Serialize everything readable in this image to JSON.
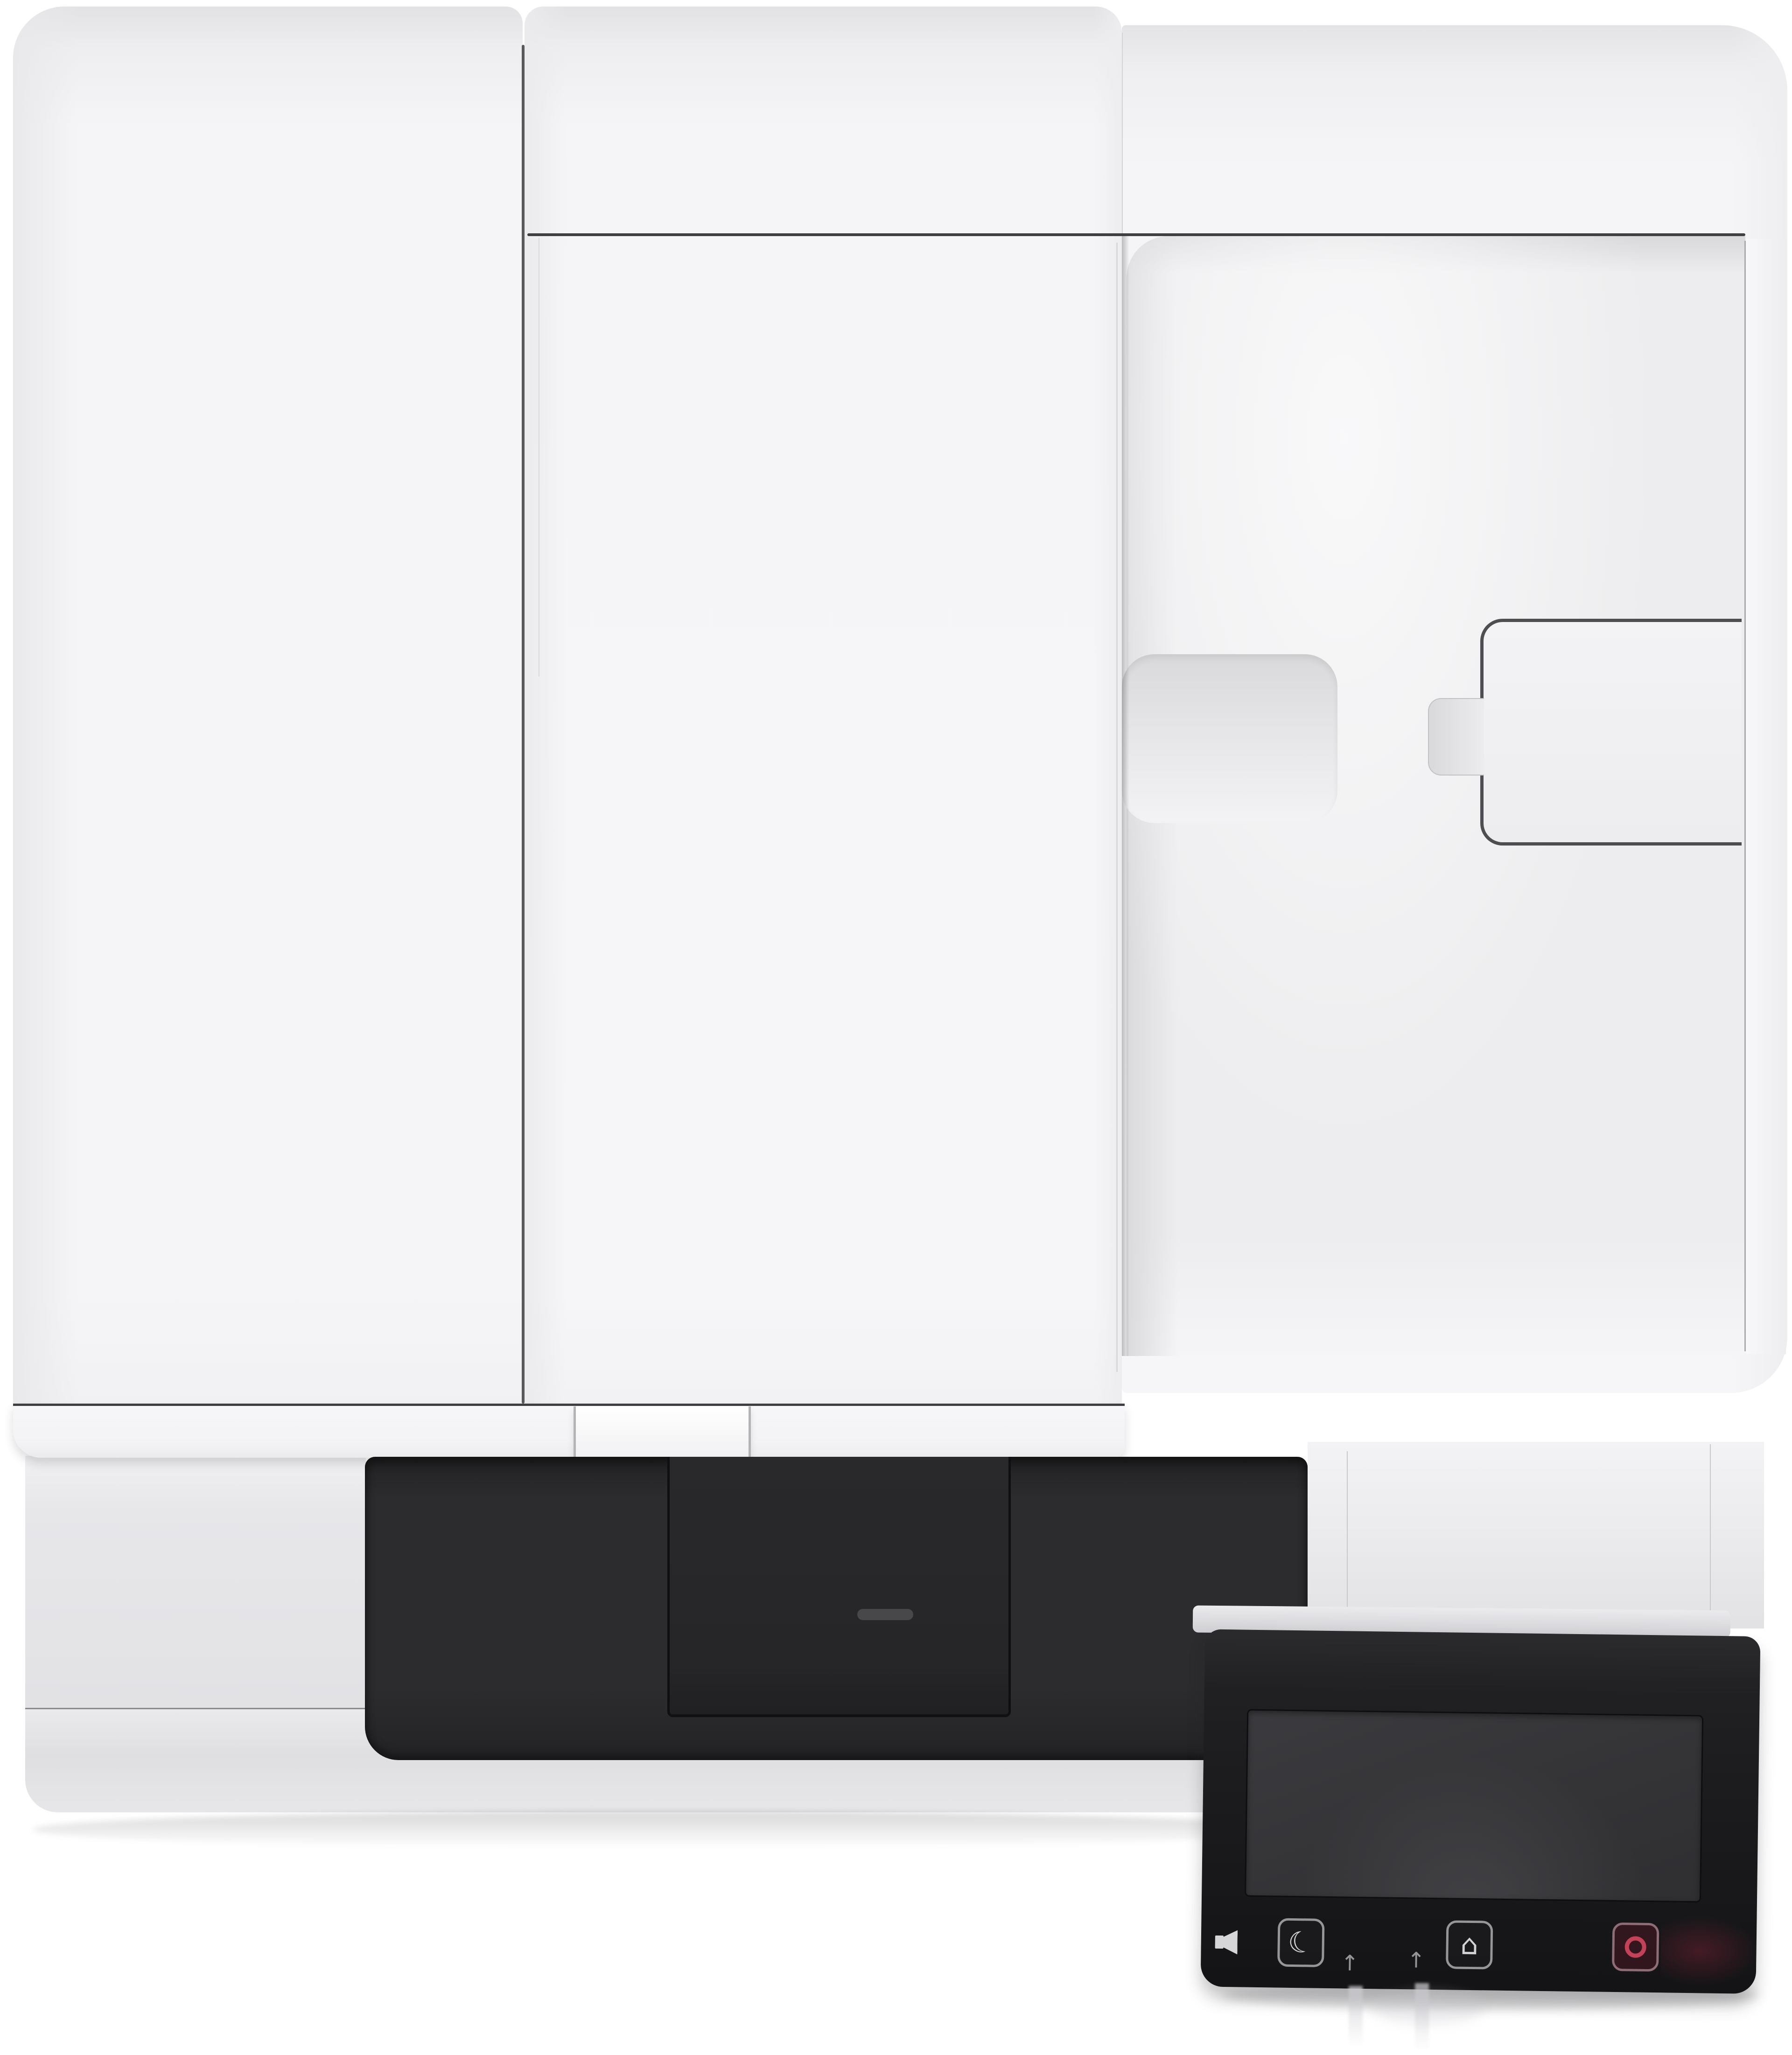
{
  "scene": {
    "type": "product-photo",
    "subject": "multifunction-laser-printer-top-view",
    "text_visible": "none"
  },
  "colors": {
    "background": "#ffffff",
    "body_white": "#f5f5f7",
    "body_shade": "#e6e6e9",
    "seam_dark": "#3f3f43",
    "recess_gray": "#ededef",
    "front_gray": "#e2e2e5",
    "slot_black": "#2a2a2c",
    "tray_black": "#28282a",
    "panel_bezel": "#1c1c1e",
    "panel_screen": "#343437",
    "button_outline": "#96969a",
    "stop_red": "#c24357",
    "icon_light": "#d6d6d8"
  },
  "printer": {
    "parts": [
      "scanner-lid-left",
      "adf-door",
      "output-tray-recess",
      "output-slot",
      "paper-stop-flap",
      "flap-latch-tab",
      "lid-handle-notch",
      "front-paper-tray-slot",
      "tray-pull-handle",
      "control-panel"
    ]
  },
  "control_panel": {
    "screen": {
      "state": "off",
      "content": ""
    },
    "volume_icon": "speaker-volume-icon",
    "buttons": [
      {
        "id": "energy-saver",
        "icon": "crescent-moon-icon",
        "glyph": "☾"
      },
      {
        "id": "home",
        "icon": "home-icon",
        "glyph": "⌂"
      },
      {
        "id": "stop",
        "icon": "stop-ring-icon",
        "glyph": ""
      }
    ],
    "indicator_arrows": [
      {
        "glyph": "↑"
      },
      {
        "glyph": "↑"
      }
    ]
  }
}
